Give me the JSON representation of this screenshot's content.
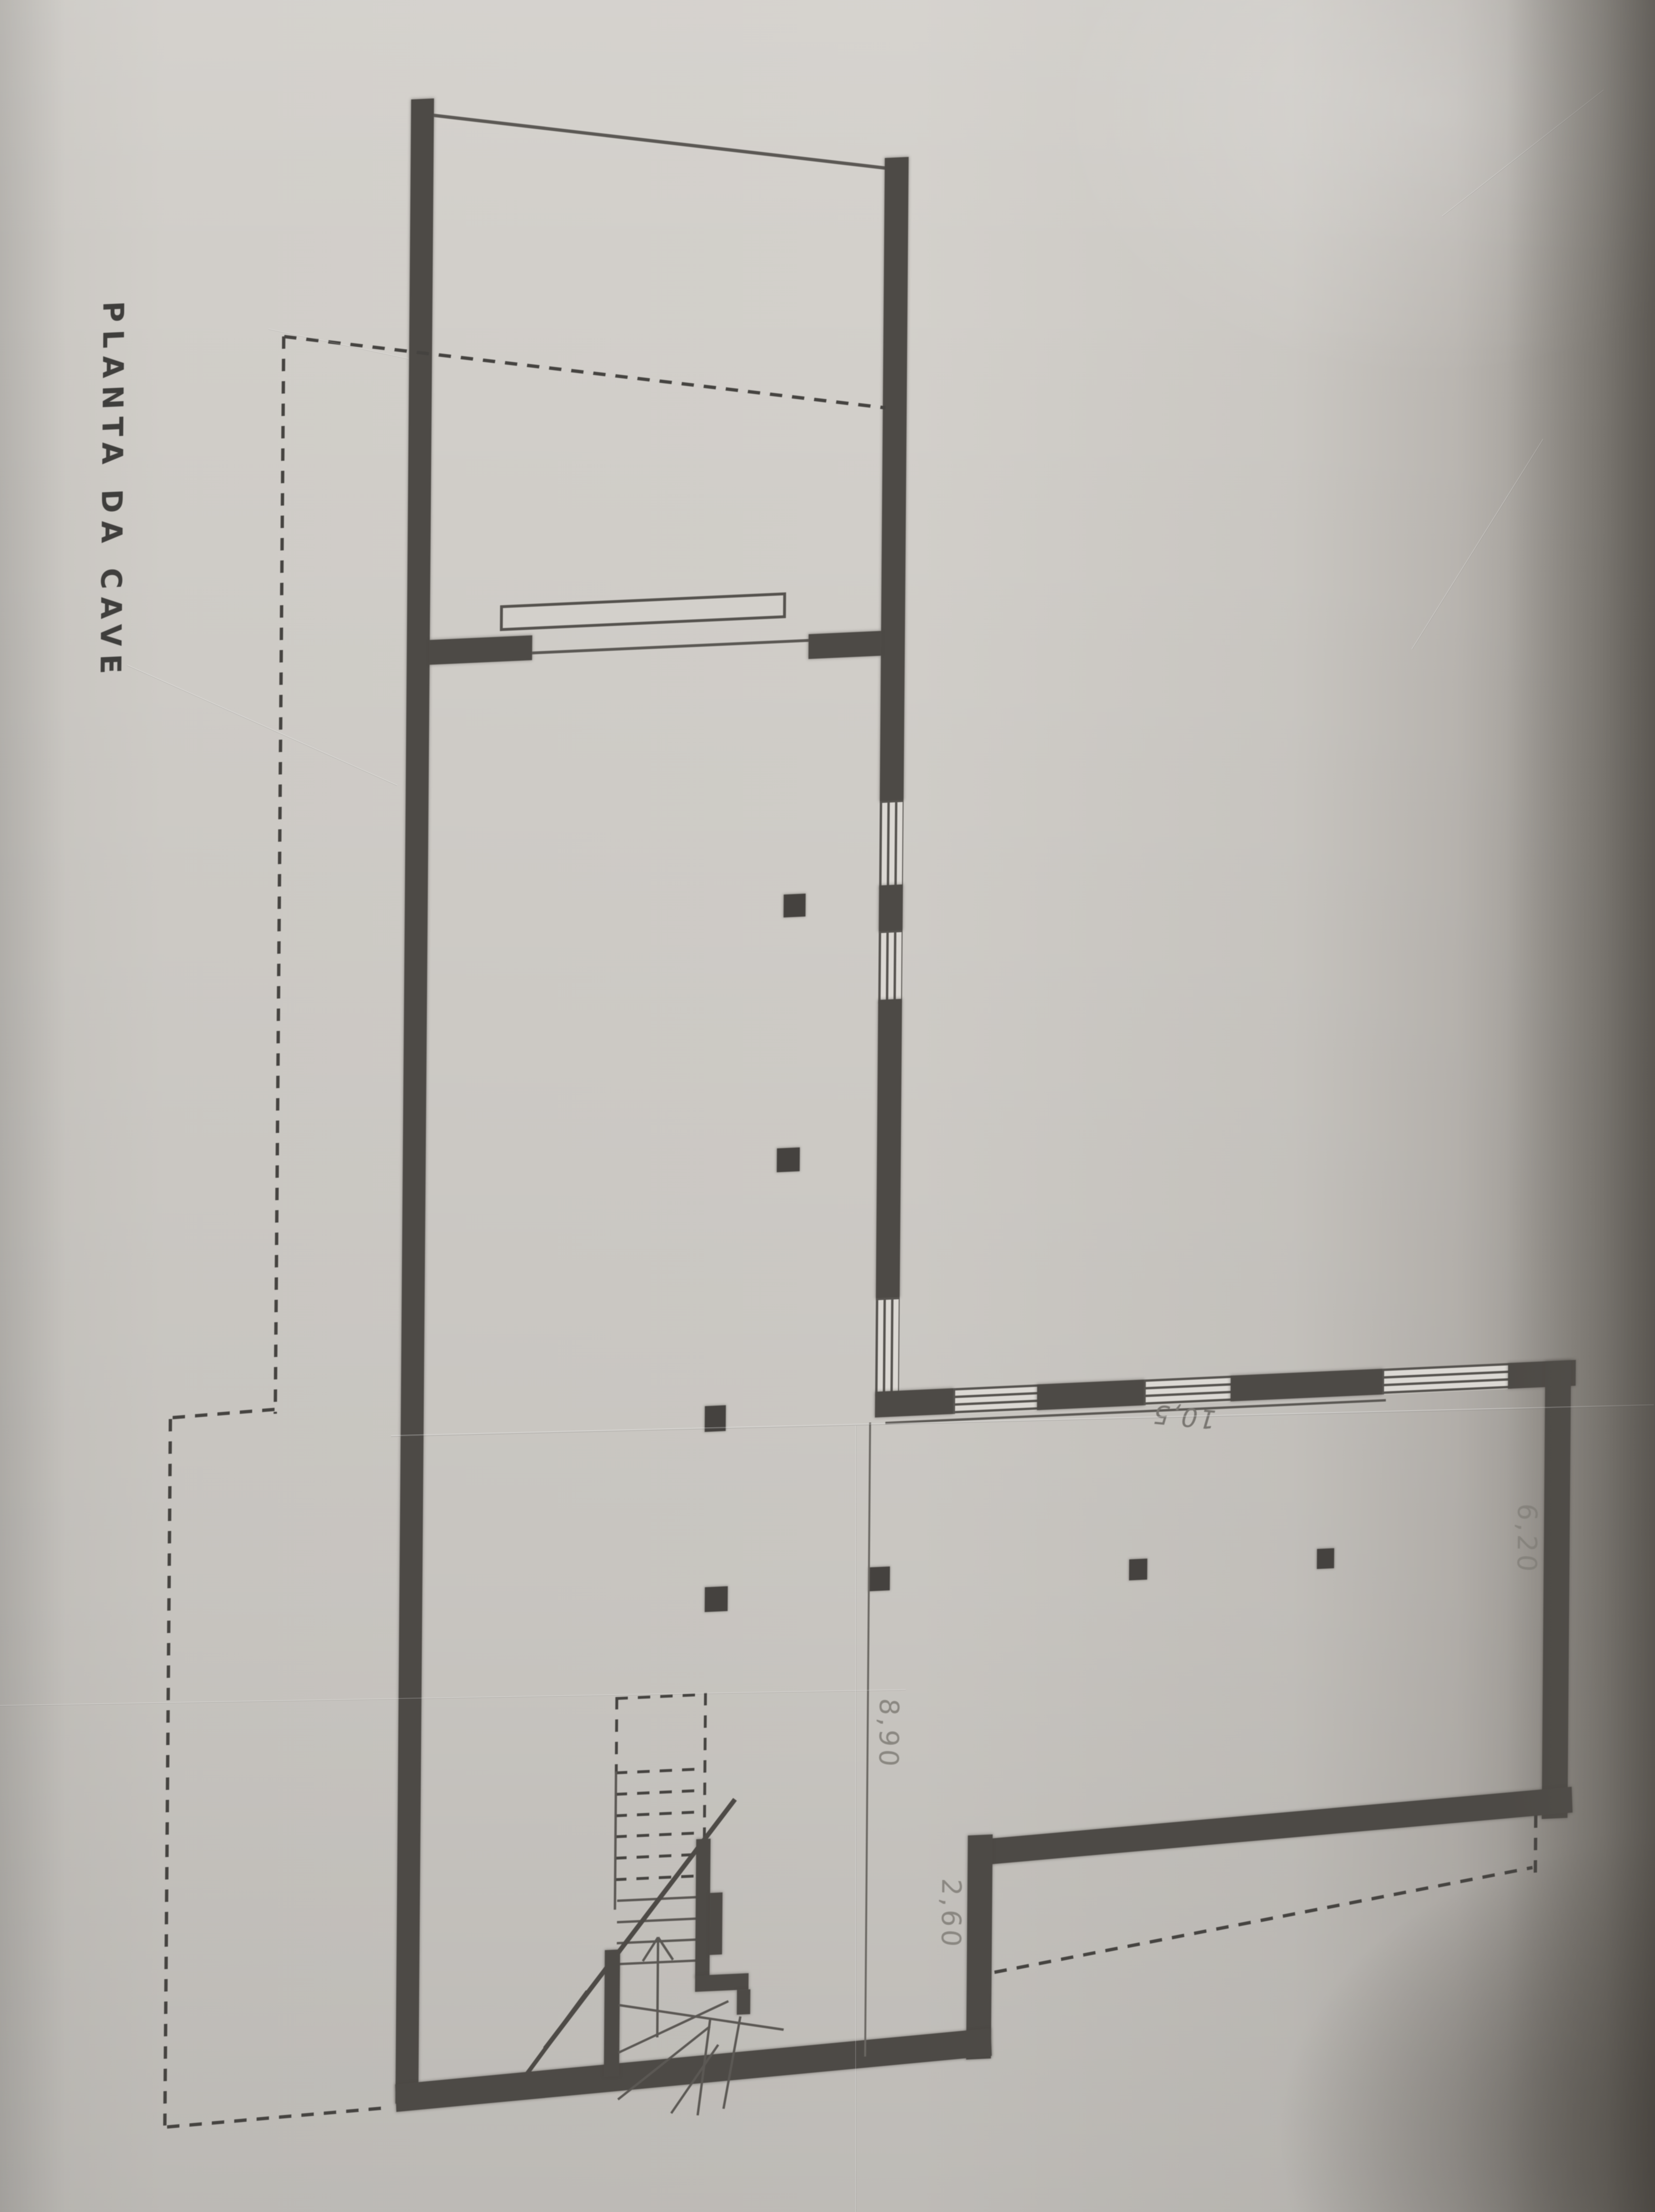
{
  "sheet": {
    "title": "PLANTA DA CAVE"
  },
  "annotations": {
    "width": "10,5",
    "depth": "6,20",
    "span": "8,90",
    "step": "2,60"
  },
  "colors": {
    "paper": "#d1cec9",
    "ink": "#4d4a46",
    "pencil": "#8a8781",
    "dashed_line": "#454340",
    "edge_shadow": "#7d7973"
  }
}
